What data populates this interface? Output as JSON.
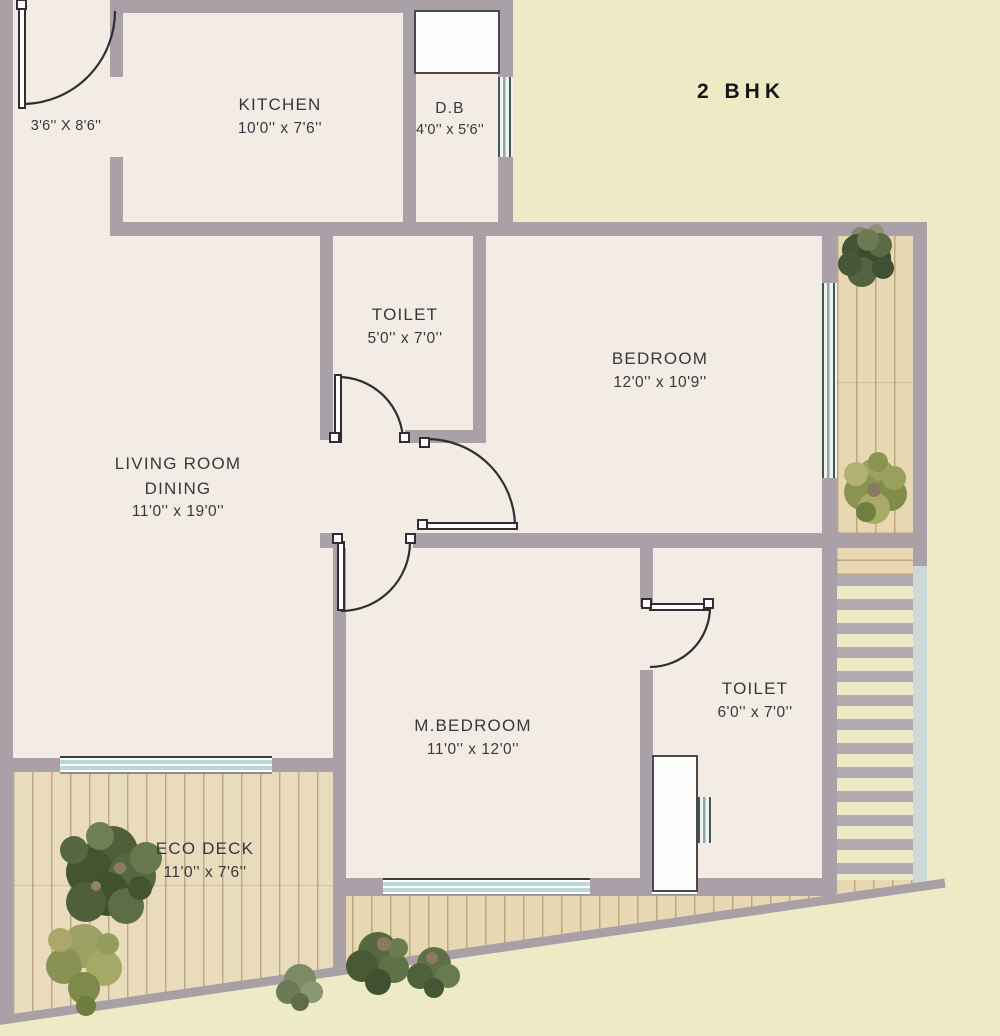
{
  "title": "2 BHK",
  "rooms": {
    "entrance": {
      "dims": "3'6'' X 8'6''"
    },
    "kitchen": {
      "name": "KITCHEN",
      "dims": "10'0'' x 7'6''"
    },
    "db": {
      "name": "D.B",
      "dims": "4'0'' x 5'6''"
    },
    "toilet1": {
      "name": "TOILET",
      "dims": "5'0'' x 7'0''"
    },
    "bedroom": {
      "name": "BEDROOM",
      "dims": "12'0'' x 10'9''"
    },
    "living": {
      "name1": "LIVING ROOM",
      "name2": "DINING",
      "dims": "11'0'' x 19'0''"
    },
    "mbedroom": {
      "name": "M.BEDROOM",
      "dims": "11'0'' x 12'0''"
    },
    "toilet2": {
      "name": "TOILET",
      "dims": "6'0'' x 7'0''"
    },
    "ecodeck": {
      "name": "ECO DECK",
      "dims": "11'0'' x 7'6''"
    }
  },
  "colors": {
    "background": "#eeeac6",
    "floor": "#f3ece4",
    "wall": "#a9a1a7",
    "wood_deck": "#e7d7b3",
    "window_glass": "#bcd8d6",
    "door_line": "#332d33",
    "label_text": "#3b3540",
    "title_text": "#161616"
  }
}
